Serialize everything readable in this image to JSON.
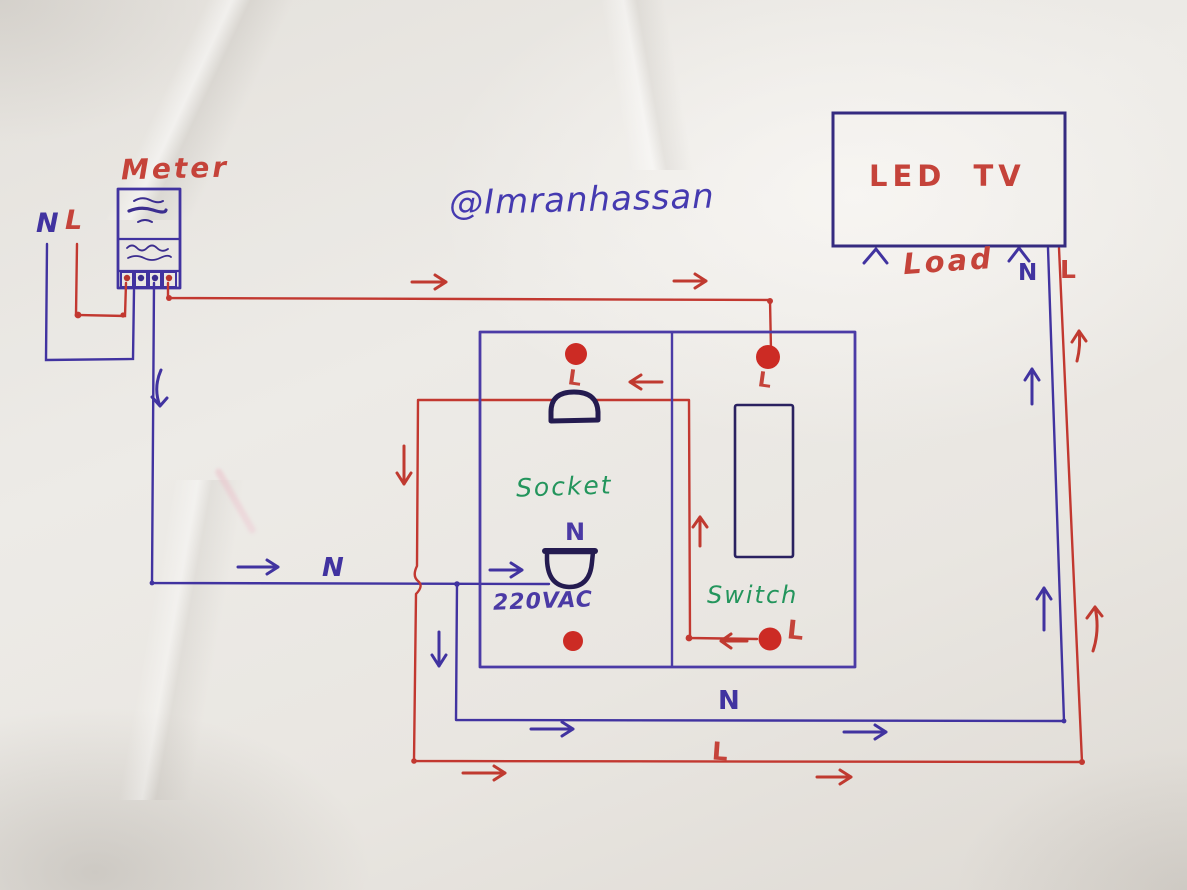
{
  "watermark": {
    "handle": "@Imranhassan"
  },
  "meter": {
    "title": "Meter",
    "incoming": {
      "neutral_label": "N",
      "live_label": "L"
    }
  },
  "panel": {
    "socket": {
      "name": "Socket",
      "live_terminal_label": "L",
      "neutral_terminal_label": "N",
      "voltage": "220VAC"
    },
    "switch": {
      "name": "Switch",
      "live_in_label": "L",
      "live_out_label": "L"
    }
  },
  "tv": {
    "title": "LED TV",
    "caption": "Load",
    "neutral_label": "N",
    "live_label": "L"
  },
  "wires": {
    "neutral_feed_label": "N",
    "neutral_return_label": "N",
    "live_return_label": "L"
  },
  "colors": {
    "live_wire": "#c23830",
    "neutral_wire": "#4133a0",
    "terminal_dot": "#cc2b24",
    "component_ink": "#261c55",
    "label_green": "#23955c",
    "label_purple": "#4b3aa5",
    "label_red": "#c5433a",
    "paper": "#e9e6e1"
  }
}
